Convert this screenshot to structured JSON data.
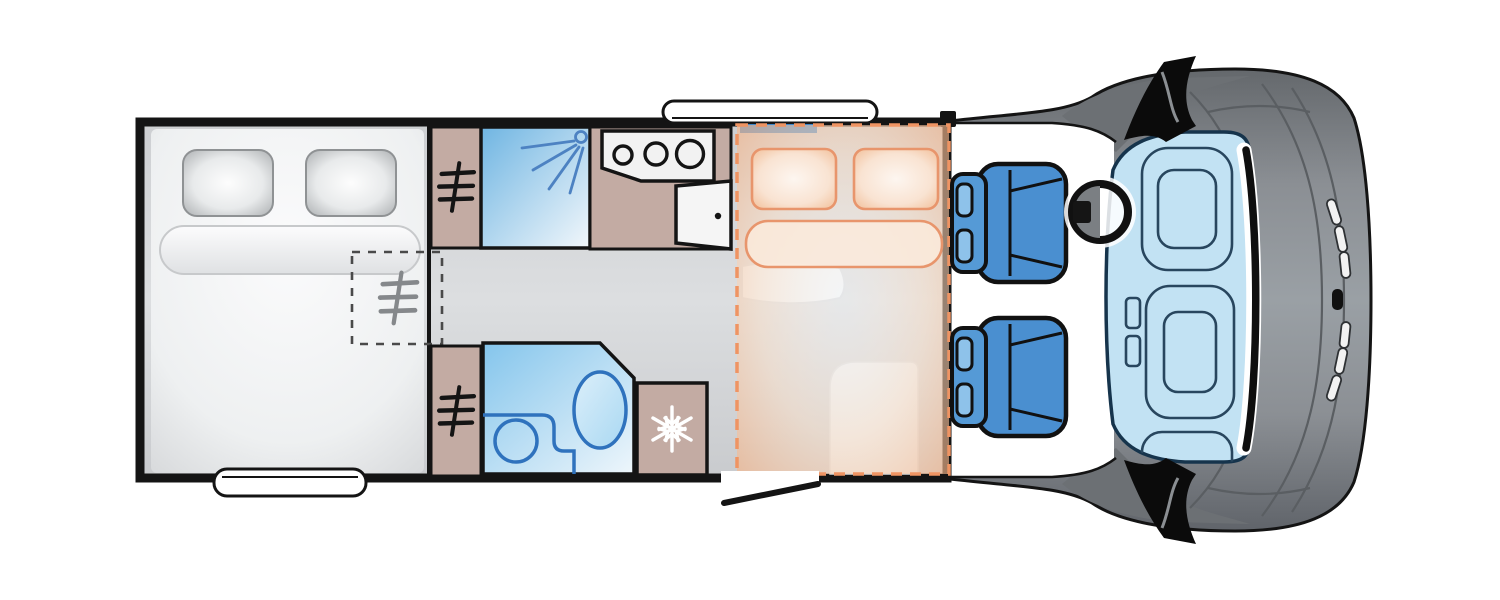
{
  "diagram": {
    "title": "Motorhome floor plan (top view, cab facing right)",
    "kind": "vehicle-floorplan"
  },
  "zones": {
    "rear_bedroom": "Rear transverse double bed with two pillows and bolster",
    "underbed_wardrobe": "Dashed wardrobe locker under bed corner",
    "wardrobe_top": "Wardrobe with hanger symbol",
    "wardrobe_bottom": "Wardrobe with hanger symbol",
    "shower": "Shower cubicle with spray symbol",
    "kitchen": "Kitchen unit with 3-burner hob",
    "entry_door": "Habitation entrance door (shown open)",
    "bathroom": "Washroom with toilet and basin",
    "fridge": "Refrigerator with snowflake symbol",
    "drop_down_bed": "Drop-down double bed (orange dashed outline) over lounge",
    "lounge": "Table and bench seat beneath drop-down bed",
    "cab": "Cab with two swivel seats, steering wheel and dashboard",
    "front_end": "Bonnet and front grille with wing mirrors"
  },
  "counts": {
    "hob_burners": 3,
    "cab_seats": 2,
    "rear_bed_pillows": 2,
    "drop_down_bed_pillows": 2,
    "wardrobe_units": 3,
    "windows": 2,
    "wing_mirrors": 2
  },
  "colors": {
    "wall": "#141414",
    "furniture_tan": "#c3aba3",
    "shower_fixture_blue": "#4d82c2",
    "bathroom_fixture_blue": "#2f72bd",
    "seat_blue": "#4a8fd0",
    "seat_blue_light": "#8ec2ea",
    "accent_orange": "#ef9463",
    "windscreen_blue": "#c2e2f3",
    "body_gray": "#8f9397",
    "snowflake_white": "#ffffff"
  }
}
